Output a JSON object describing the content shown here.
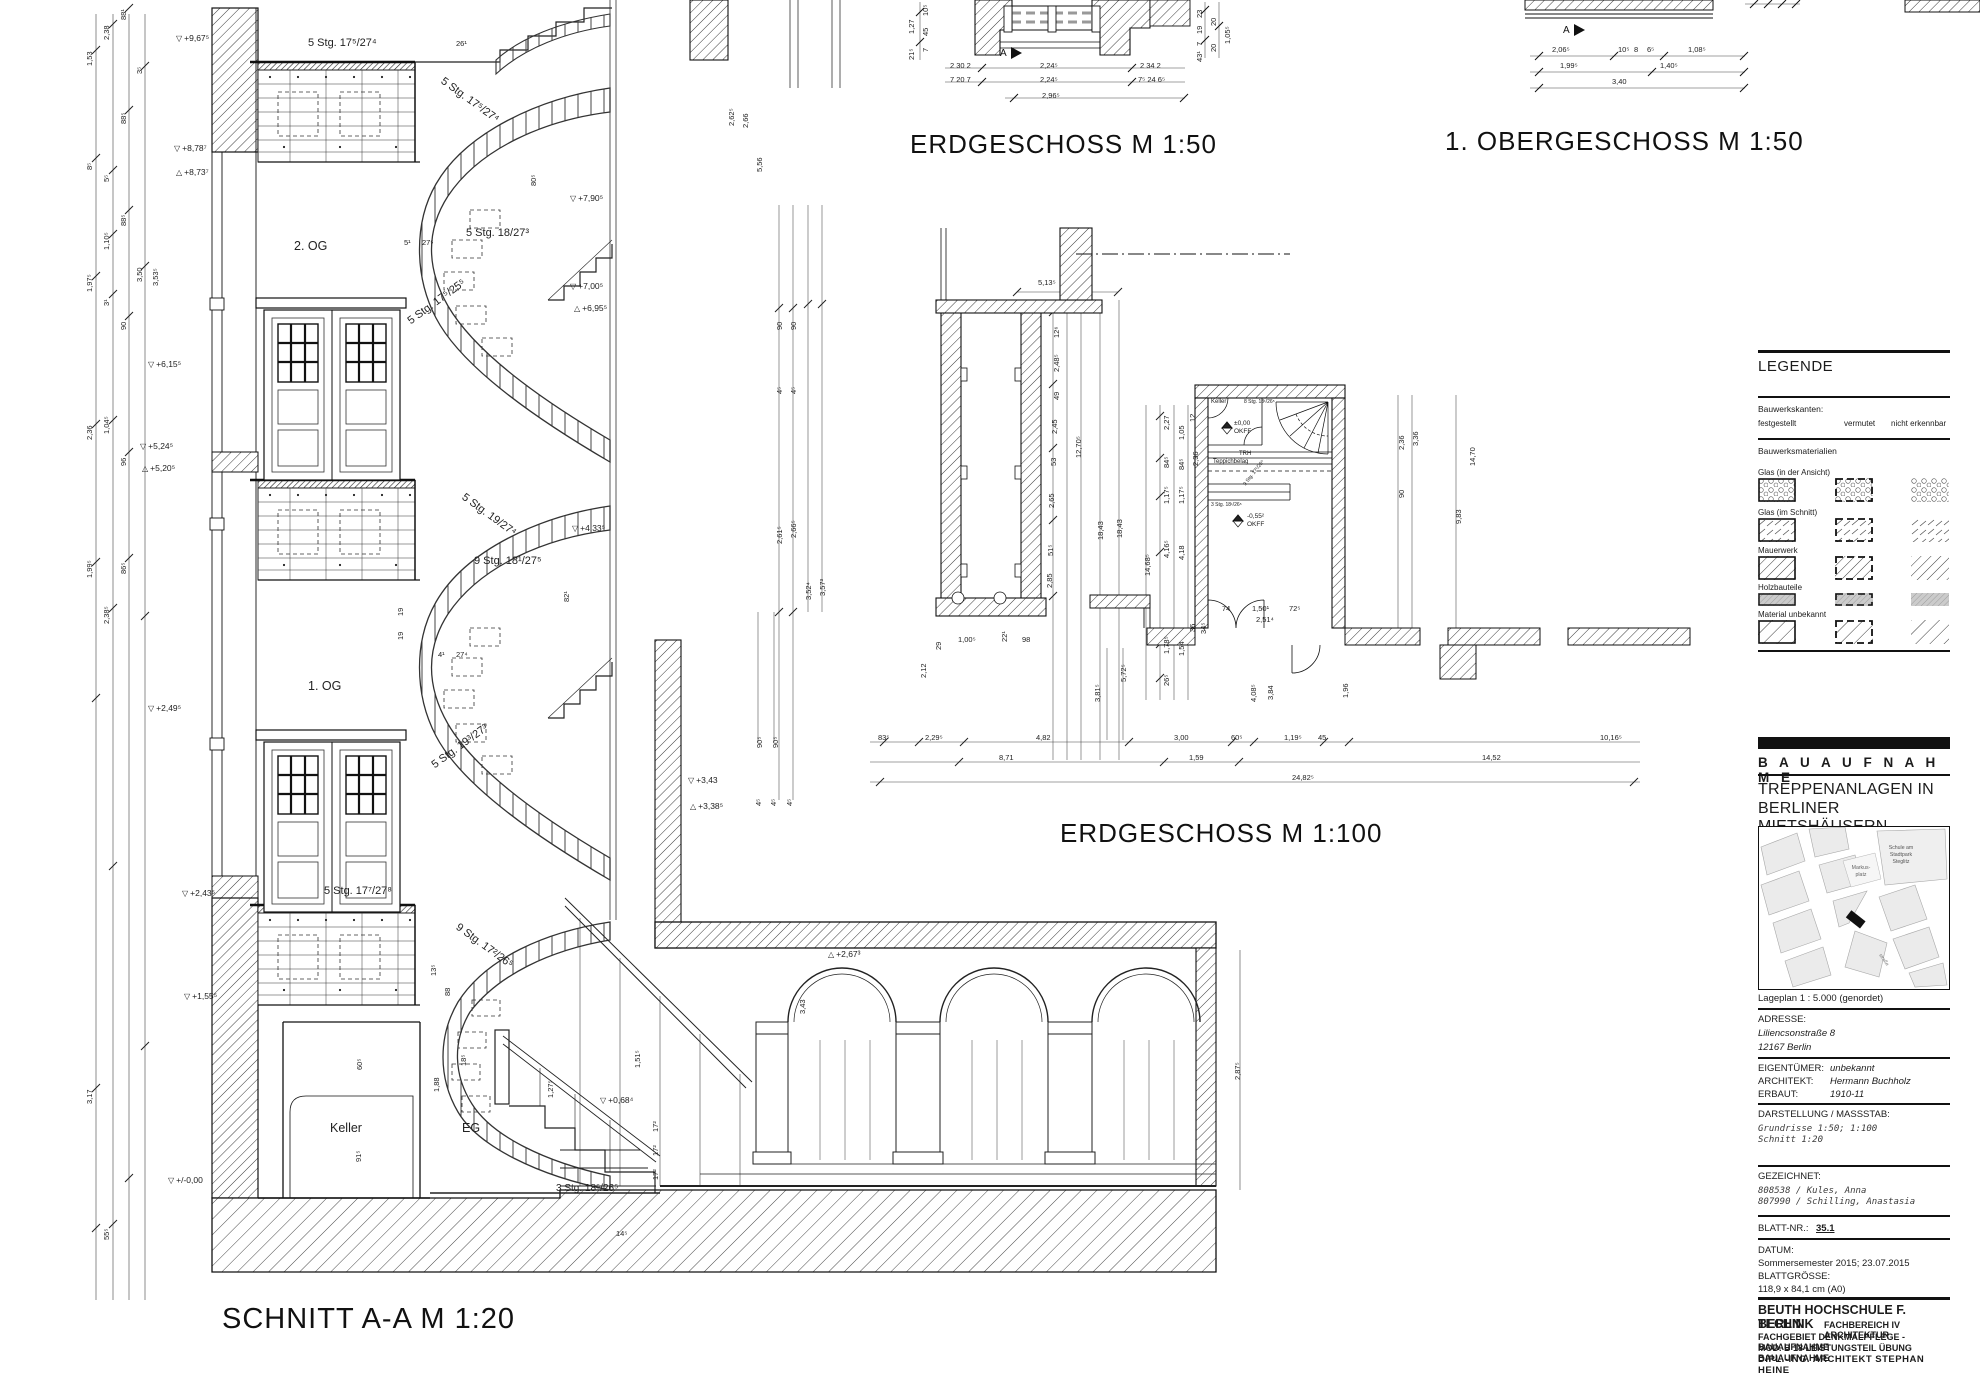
{
  "titles": {
    "schnitt": "SCHNITT A-A   M 1:20",
    "eg50": "ERDGESCHOSS   M 1:50",
    "og50": "1. OBERGESCHOSS   M 1:50",
    "eg100": "ERDGESCHOSS   M 1:100"
  },
  "section": {
    "floors": {
      "og2": "2. OG",
      "og1": "1. OG",
      "eg": "EG",
      "keller": "Keller"
    },
    "stairs": [
      "5 Stg. 17⁵/27⁴",
      "5 Stg. 17⁵/27⁴",
      "5 Stg. 18/27³",
      "5 Stg. 17⁵/25⁵",
      "5 Stg. 19/27⁴",
      "9 Stg. 18¹/27⁵",
      "5 Stg. 19³/27³",
      "5 Stg. 17⁷/27⁸",
      "9 Stg. 17²/26⁵",
      "3 Stg. 18⁵/26⁵"
    ],
    "elev_tris": [
      "▽",
      "▽",
      "△",
      "▽",
      "▽",
      "△",
      "▽",
      "▽",
      "△",
      "▽",
      "▽",
      "△",
      "△",
      "▽",
      "▽",
      "▽",
      "▽",
      "▽"
    ],
    "elevations": [
      "+9,67⁵",
      "+8,78⁷",
      "+8,73⁷",
      "+7,90⁵",
      "+7,00⁵",
      "+6,95⁵",
      "+6,15⁵",
      "+5,24⁵",
      "+5,20⁵",
      "+4,33⁵",
      "+3,43",
      "+3,38⁵",
      "+2,67³",
      "+2,49⁵",
      "+2,43⁵",
      "+1,55⁵",
      "+0,68⁴",
      "+/-0,00"
    ],
    "dims_left": [
      "1,53",
      "2,38",
      "88¹",
      "3⁵",
      "8⁵",
      "5⁵",
      "88⁵",
      "1,10⁵",
      "88⁵",
      "1,97⁵",
      "3¹",
      "90",
      "3,50",
      "3,53⁵",
      "2,36",
      "1,04⁵",
      "96",
      "1,99⁵",
      "2,38⁵",
      "86⁵",
      "3,17",
      "55⁵"
    ],
    "dims_misc": [
      "80⁵",
      "82¹",
      "26¹",
      "5¹",
      "27⁵",
      "19",
      "19",
      "4¹",
      "27⁴",
      "13⁵",
      "88",
      "18⁵",
      "1,88",
      "60⁵",
      "91⁵",
      "1,27⁵",
      "1,51⁵",
      "17²",
      "17²",
      "17²",
      "14⁵",
      "2,87⁵",
      "3,43",
      "2,62⁵",
      "2,66",
      "5,56",
      "90⁵",
      "90⁵",
      "4⁵",
      "4⁵",
      "4⁵"
    ]
  },
  "plan100": {
    "dims": [
      "5,13⁵",
      "90",
      "90",
      "4⁵",
      "4⁵",
      "2,61⁵",
      "2,66⁵",
      "3,52⁴",
      "3,57³",
      "12⁶",
      "2,48⁵",
      "49",
      "2,45",
      "53",
      "2,65",
      "51⁵",
      "2,85",
      "12,70⁵",
      "18,43",
      "18,43",
      "2,27",
      "1,05",
      "12",
      "84⁵",
      "84⁵",
      "2,36",
      "1,17⁵",
      "1,17⁵",
      "4,16⁵",
      "4,18",
      "14,68⁵",
      "1,78⁵",
      "1,54",
      "36",
      "34⁵",
      "26⁵",
      "74",
      "1,50¹",
      "72⁵",
      "2,51⁴",
      "2,36",
      "3,36",
      "90",
      "9,83",
      "14,70",
      "29",
      "1,00⁵",
      "22¹",
      "98",
      "2,12",
      "3,81⁵",
      "5,72⁵",
      "4,08⁵",
      "3,84",
      "1,96",
      "83⁵",
      "2,29⁵",
      "4,82",
      "3,00",
      "60⁵",
      "1,19⁵",
      "45",
      "10,16⁵",
      "8,71",
      "1,59",
      "14,52",
      "24,82⁵"
    ],
    "texts": {
      "keller": "Keller",
      "stair8": "8 Stg. 18¹/26⁵",
      "lvl0": "±0,00",
      "okff1": "OKFF",
      "trh": "TRH",
      "teppich": "Teppichbelag",
      "stair9": "9 Stg. 17¹/26⁵",
      "stair3": "3 Stg. 18¹/26⁵",
      "lvlm": "-0,55²",
      "okff2": "OKFF"
    }
  },
  "plan50eg": {
    "marker": "A",
    "row1": [
      "2  30  2",
      "2,24⁵",
      "2  34  2"
    ],
    "row2": [
      "7  20  7",
      "2,24⁵",
      "7⁵ 24 6⁵"
    ],
    "row3": "2,96⁵",
    "side_left": [
      "1,27",
      "10⁵",
      "45",
      "7",
      "21⁵"
    ],
    "side_right": [
      "23",
      "19",
      "7",
      "43¹",
      "20",
      "20",
      "1,05⁵"
    ]
  },
  "plan50og": {
    "marker": "A",
    "row1": [
      "2,06⁵",
      "10⁵",
      "8",
      "6⁵",
      "1,08⁵"
    ],
    "row2": [
      "1,99⁵",
      "1,40⁵"
    ],
    "row3": "3,40"
  },
  "legend": {
    "title": "LEGENDE",
    "kanten_label": "Bauwerkskanten:",
    "kanten": [
      "festgestellt",
      "vermutet",
      "nicht erkennbar"
    ],
    "mat_label": "Bauwerksmaterialien",
    "materials": [
      "Glas (in der Ansicht)",
      "Glas (im Schnitt)",
      "Mauerwerk",
      "Holzbauteile",
      "Material unbekannt"
    ]
  },
  "map": {
    "school": "Schule am Stadtpark Steglitz",
    "platz": "Markus- platz",
    "caption": "Lageplan 1 : 5.000 (genordet)"
  },
  "titleblock": {
    "brand": "B A U A U F N A H M E",
    "project1": "TREPPENANLAGEN IN",
    "project2": "BERLINER MIETSHÄUSERN",
    "adresse_label": "ADRESSE:",
    "adresse1": "Liliencsonstraße 8",
    "adresse2": "12167 Berlin",
    "rows": [
      [
        "EIGENTÜMER:",
        "unbekannt"
      ],
      [
        "ARCHITEKT:",
        "Hermann Buchholz"
      ],
      [
        "ERBAUT:",
        "1910-11"
      ]
    ],
    "darstellung_label": "DARSTELLUNG / MASSSTAB:",
    "darstellung1": "Grundrisse 1:50; 1:100",
    "darstellung2": "Schnitt 1:20",
    "gezeichnet_label": "GEZEICHNET:",
    "gez1": "808538 / Kules, Anna",
    "gez2": "807990 / Schilling, Anastasia",
    "blatt_label": "BLATT-NR.:",
    "blatt": "35.1",
    "datum_label": "DATUM:",
    "datum": "Sommersemester 2015; 23.07.2015",
    "groesse_label": "BLATTGRÖSSE:",
    "groesse": "118,9 x 84,1 cm (A0)",
    "school1": "BEUTH   HOCHSCHULE F. TECHNIK",
    "school2": "BERLIN",
    "school3": "FACHBEREICH IV ARCHITEKTUR",
    "school4": "FACHGEBIET DENKMALPFLEGE    - BAUAUFNAHME",
    "school5": "MOD. B 18   LEISTUNGSTEIL ÜBUNG BAUAUFNAHME",
    "school6": "DIPL.-ING. ARCHITEKT    STEPHAN HEINE"
  }
}
